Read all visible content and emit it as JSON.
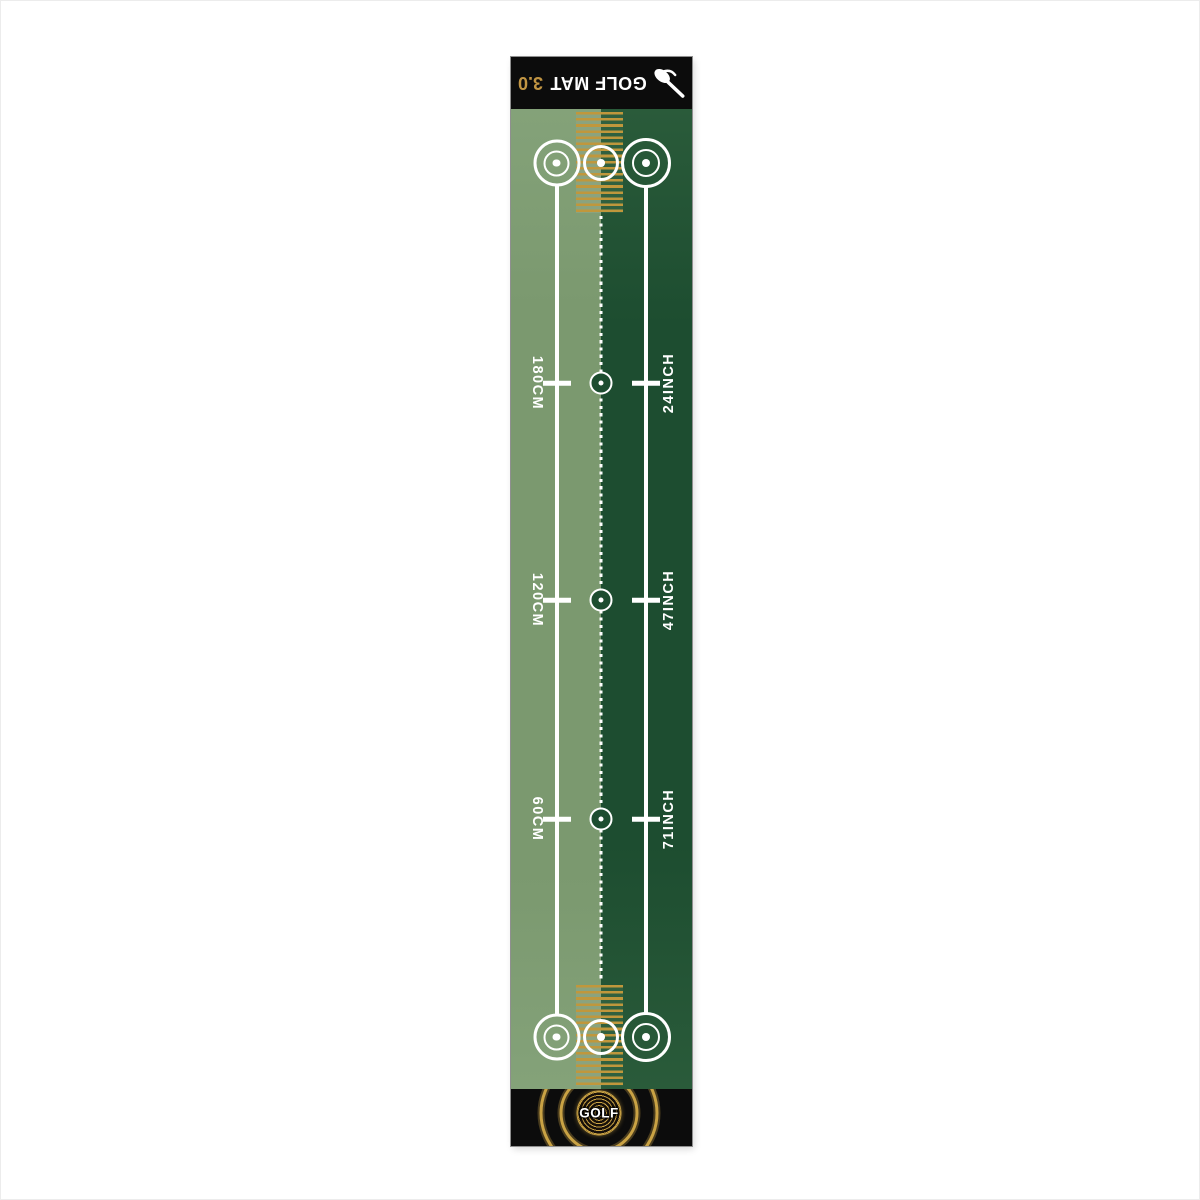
{
  "meta": {
    "description": "Golf putting practice mat product image on white background"
  },
  "colors": {
    "page_bg": "#ffffff",
    "frame": "#ececec",
    "mat_edge": "#8f8f8f",
    "band_black": "#0c0c0c",
    "light_green": "#7b996f",
    "light_green_edge": "#84a279",
    "dark_green": "#1d4d30",
    "dark_green_edge": "#2a5b3a",
    "gold": "#c0973c",
    "emblem_gold": "#c9a244",
    "version_gold": "#c19543"
  },
  "header": {
    "title": "GOLF MAT",
    "version": "3.0",
    "icon": "putter-icon",
    "orientation": "rotated-180"
  },
  "scale": {
    "rows": [
      {
        "cm": "180CM",
        "inch": "24INCH"
      },
      {
        "cm": "120CM",
        "inch": "47INCH"
      },
      {
        "cm": "60CM",
        "inch": "71INCH"
      }
    ]
  },
  "footer": {
    "logo_text": "GOLF",
    "icon": "golf-ball-logo"
  }
}
